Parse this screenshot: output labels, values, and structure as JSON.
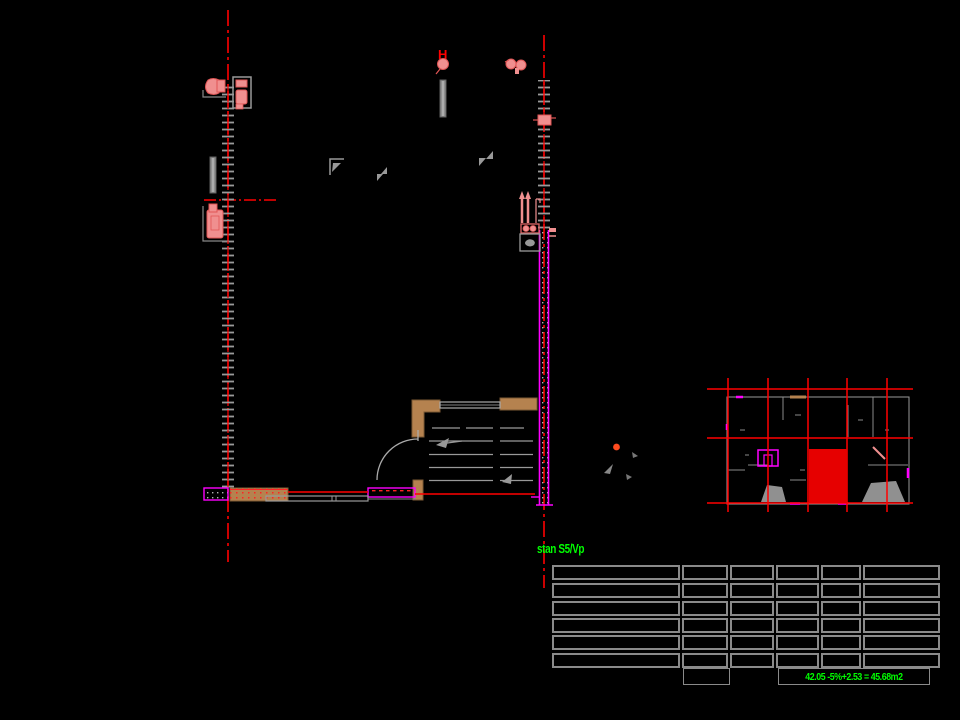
{
  "labels": {
    "apartment": "stan S5/Vp",
    "area_formula": "42.05 -5%+2.53 = 45.68m2",
    "hydrant": "H"
  },
  "colors": {
    "background": "#000000",
    "axis_red": "#ff0000",
    "highlight_red": "#e60000",
    "wall_magenta": "#ff00ff",
    "fixture_pink": "#f08f8f",
    "wood_brown": "#b5824f",
    "annotation_green": "#00ff00",
    "line_gray": "#9a9a9a",
    "table_border_gray": "#8a8a8a"
  },
  "area_table": {
    "rows": 6,
    "columns": 6
  }
}
